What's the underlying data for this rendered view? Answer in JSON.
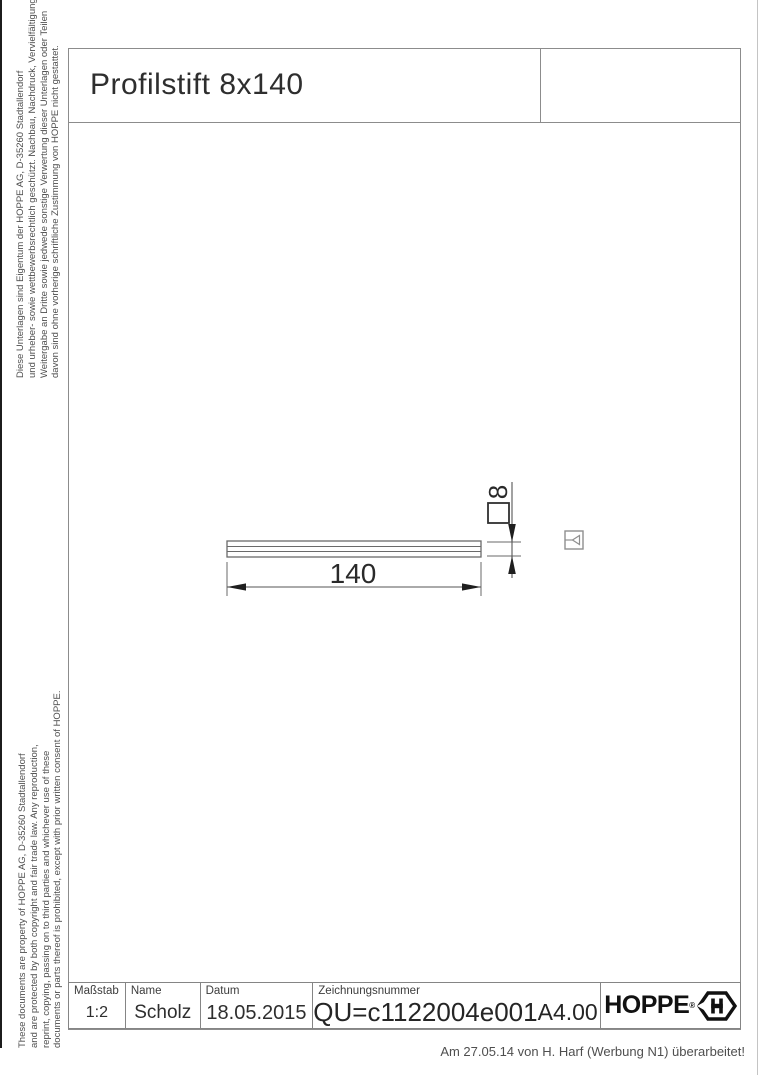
{
  "header": {
    "title": "Profilstift 8x140"
  },
  "side_notes": {
    "top_de": [
      "Diese Unterlagen sind Eigentum der  HOPPE AG, D-35260 Stadtallendorf",
      "und urheber- sowie wettbewerbsrechtlich geschützt. Nachbau, Nachdruck, Vervielfältigung,",
      "Weitergabe an Dritte sowie jedwede sonstige Verwertung dieser Unterlagen oder Teilen",
      "davon sind ohne vorherige schriftliche Zustimmung von HOPPE nicht gestattet."
    ],
    "bottom_en": [
      "These documents are property of  HOPPE AG, D-35260 Stadtallendorf",
      "and are protected by both copyright and fair trade law. Any reproduction,",
      "reprint, copying, passing on to third parties and whichever use of these",
      "documents or parts thereof is prohibited, except with prior written consent of  HOPPE."
    ]
  },
  "drawing": {
    "part": "Profilstift",
    "length_label": "140",
    "section_label": "8"
  },
  "title_block": {
    "fields": [
      {
        "label": "Maßstab",
        "value": "1:2"
      },
      {
        "label": "Name",
        "value": "Scholz"
      },
      {
        "label": "Datum",
        "value": "18.05.2015"
      },
      {
        "label": "Zeichnungsnummer",
        "value": "QU=c1122004e001",
        "format": "A4.00"
      }
    ],
    "logo_text": "HOPPE",
    "logo_reg": "®"
  },
  "footer": {
    "revision_note": "Am 27.05.14 von H. Harf (Werbung N1) überarbeitet!"
  },
  "colors": {
    "line": "#8c8c8c",
    "drawing_line": "#6a6a6a",
    "arrow": "#1f1f1f",
    "text": "#2f2f2f"
  }
}
